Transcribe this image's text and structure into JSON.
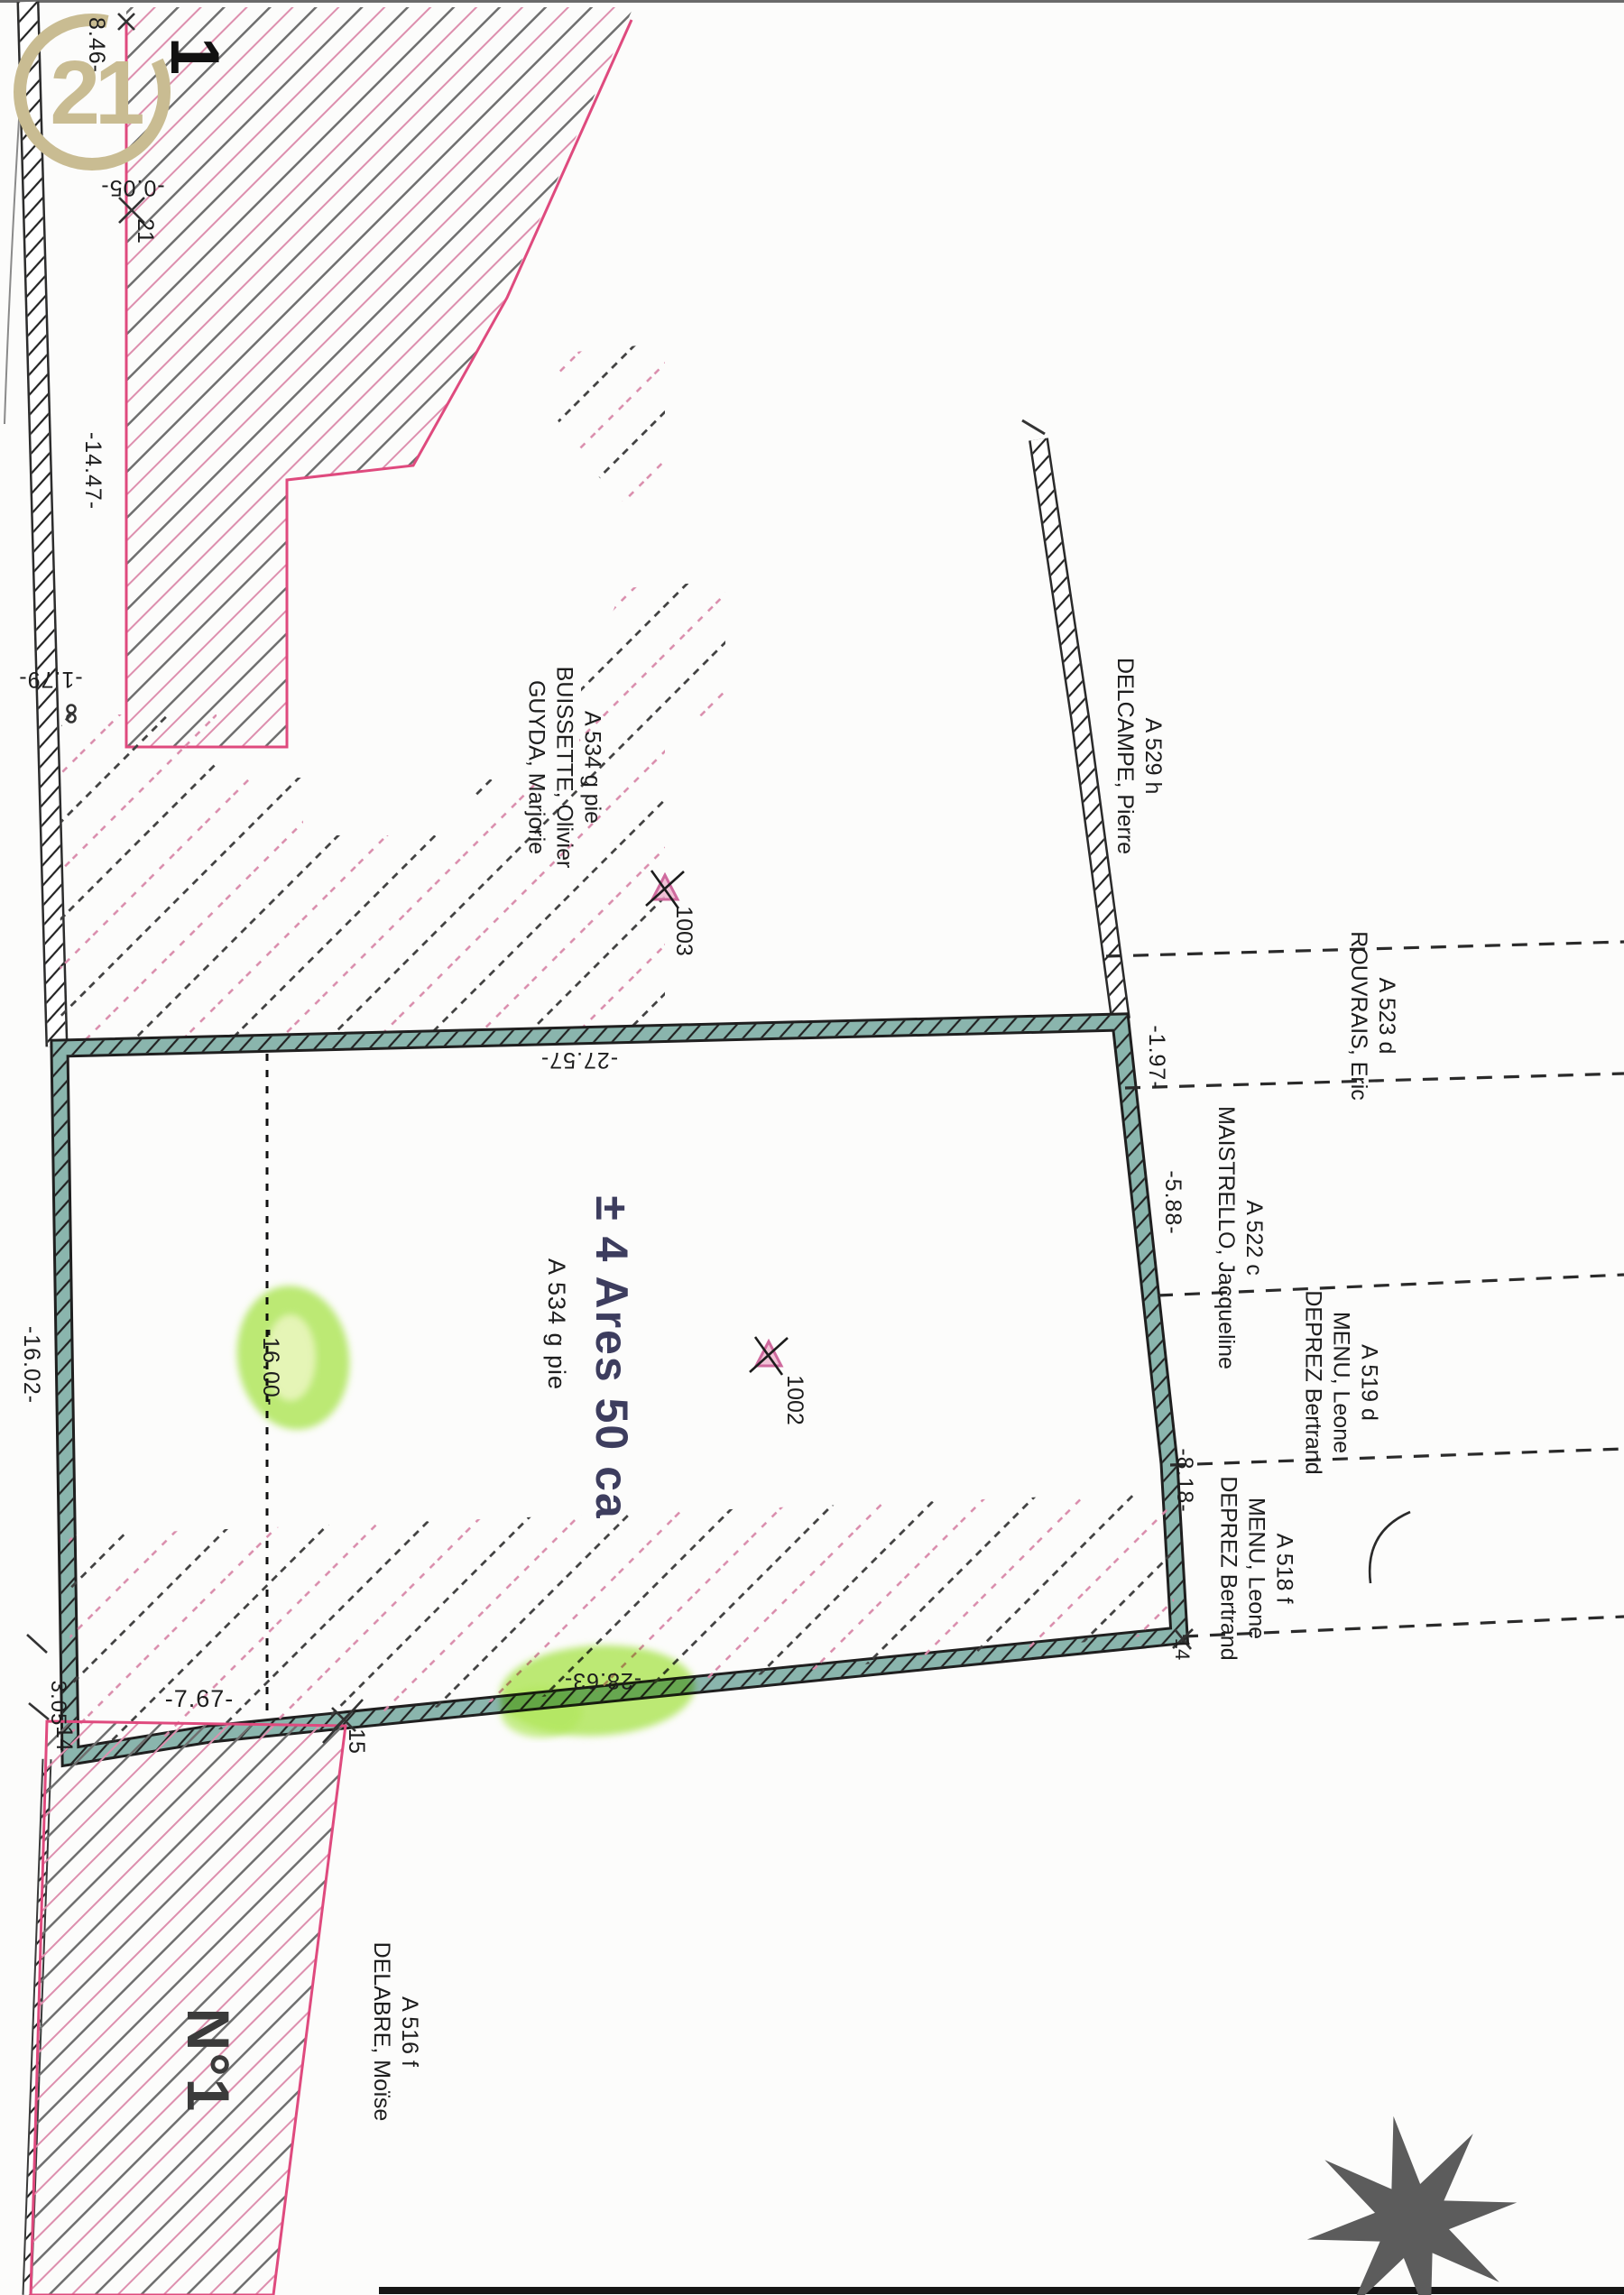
{
  "icons": {
    "logo": "century21-seal-icon",
    "compass": "compass-rose-icon",
    "survey_point": "survey-point-marker-icon"
  },
  "colors": {
    "boundary_pink": "#df4a7e",
    "hatch_pink": "#dd8fae",
    "hatch_gray": "#6f6f6f",
    "teal_band": "#8ab5ad",
    "highlight_green": "#b3e95e",
    "area_text_navy": "#3d3d5e",
    "logo_tan": "#c9bc92",
    "compass_gray": "#5c5c5c"
  },
  "logo": {
    "text": "21"
  },
  "annotations": {
    "big_numeral": "1"
  },
  "main_parcel": {
    "area": "± 4 Ares 50 ca",
    "ref": "A 534 g pie",
    "lot": "N°1",
    "edge_top": "-27.57-",
    "edge_bottom": "-28.63-",
    "edge_left": "-16.02-",
    "split_line": "-16.00-"
  },
  "adjacent_parcels": {
    "buissette": {
      "ref": "A 534 g pie",
      "owner1": "BUISSETTE, Olivier",
      "owner2": "GUYDA, Marjorie"
    },
    "delcampe": {
      "ref": "A 529 h",
      "owner1": "DELCAMPE, Pierre"
    },
    "rouvrais": {
      "ref": "A 523 d",
      "owner1": "ROUVRAIS, Eric"
    },
    "maistrello": {
      "ref": "A 522 c",
      "owner1": "MAISTRELLO, Jacqueline"
    },
    "menu_519": {
      "ref": "A 519 d",
      "owner1": "MENU, Leone",
      "owner2": "DEPREZ Bertrand"
    },
    "menu_518": {
      "ref": "A 518 f",
      "owner1": "MENU, Leone",
      "owner2": "DEPREZ Bertrand"
    },
    "delabre": {
      "ref": "A 516 f",
      "owner1": "DELABRE, Moïse"
    }
  },
  "measurements": {
    "top_846": "8.46-",
    "pt_005": "-0.05-",
    "left_1447": "-14.47-",
    "left_179": "-1.79-",
    "right_197": "-1.97-",
    "right_588": "-5.88-",
    "right_818": "-8.18-",
    "bottom_767": "-7.67-",
    "bottom_305": "3.05"
  },
  "points": {
    "n21": "21",
    "n14_left": "14",
    "n14_right": "14",
    "n15": "15",
    "n1002": "1002",
    "n1003": "1003"
  }
}
